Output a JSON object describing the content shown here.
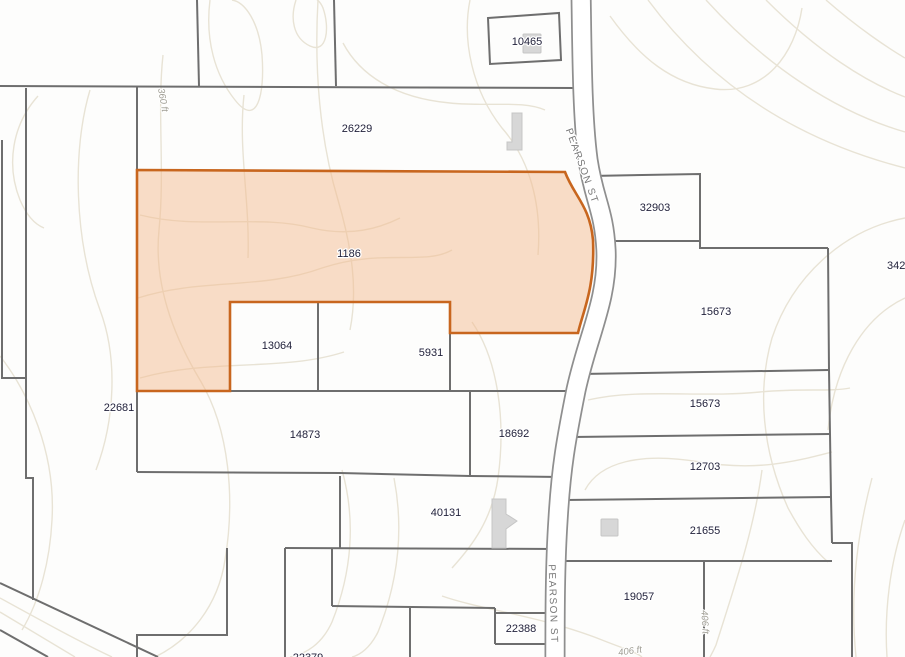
{
  "map": {
    "description": "County GIS parcel map with selected parcel highlighted along Pearson St",
    "colors": {
      "background": "#FDFDFC",
      "parcel_line": "#6E6E6E",
      "contour_line": "#E8E3D5",
      "road_fill": "#FFFFFF",
      "road_casing": "#8F8F8F",
      "highlight_fill": "rgba(243,187,143,0.5)",
      "highlight_border": "#C8661E",
      "parcel_label": "#23233C",
      "contour_label": "#A09E94",
      "road_label": "#777777",
      "building_fill": "#D7D7D7"
    },
    "highlighted_parcel": {
      "id": "1186"
    },
    "parcel_labels": [
      {
        "text": "10465"
      },
      {
        "text": "26229"
      },
      {
        "text": "32903"
      },
      {
        "text": "1186"
      },
      {
        "text": "342"
      },
      {
        "text": "15673"
      },
      {
        "text": "13064"
      },
      {
        "text": "5931"
      },
      {
        "text": "15673"
      },
      {
        "text": "22681"
      },
      {
        "text": "14873"
      },
      {
        "text": "18692"
      },
      {
        "text": "12703"
      },
      {
        "text": "40131"
      },
      {
        "text": "21655"
      },
      {
        "text": "19057"
      },
      {
        "text": "22388"
      },
      {
        "text": "22379"
      }
    ],
    "road_labels": [
      {
        "text": "PEARSON ST"
      },
      {
        "text": "PEARSON ST"
      }
    ],
    "contour_labels": [
      {
        "text": "360 ft"
      },
      {
        "text": "406 ft"
      },
      {
        "text": "406 ft"
      }
    ]
  }
}
